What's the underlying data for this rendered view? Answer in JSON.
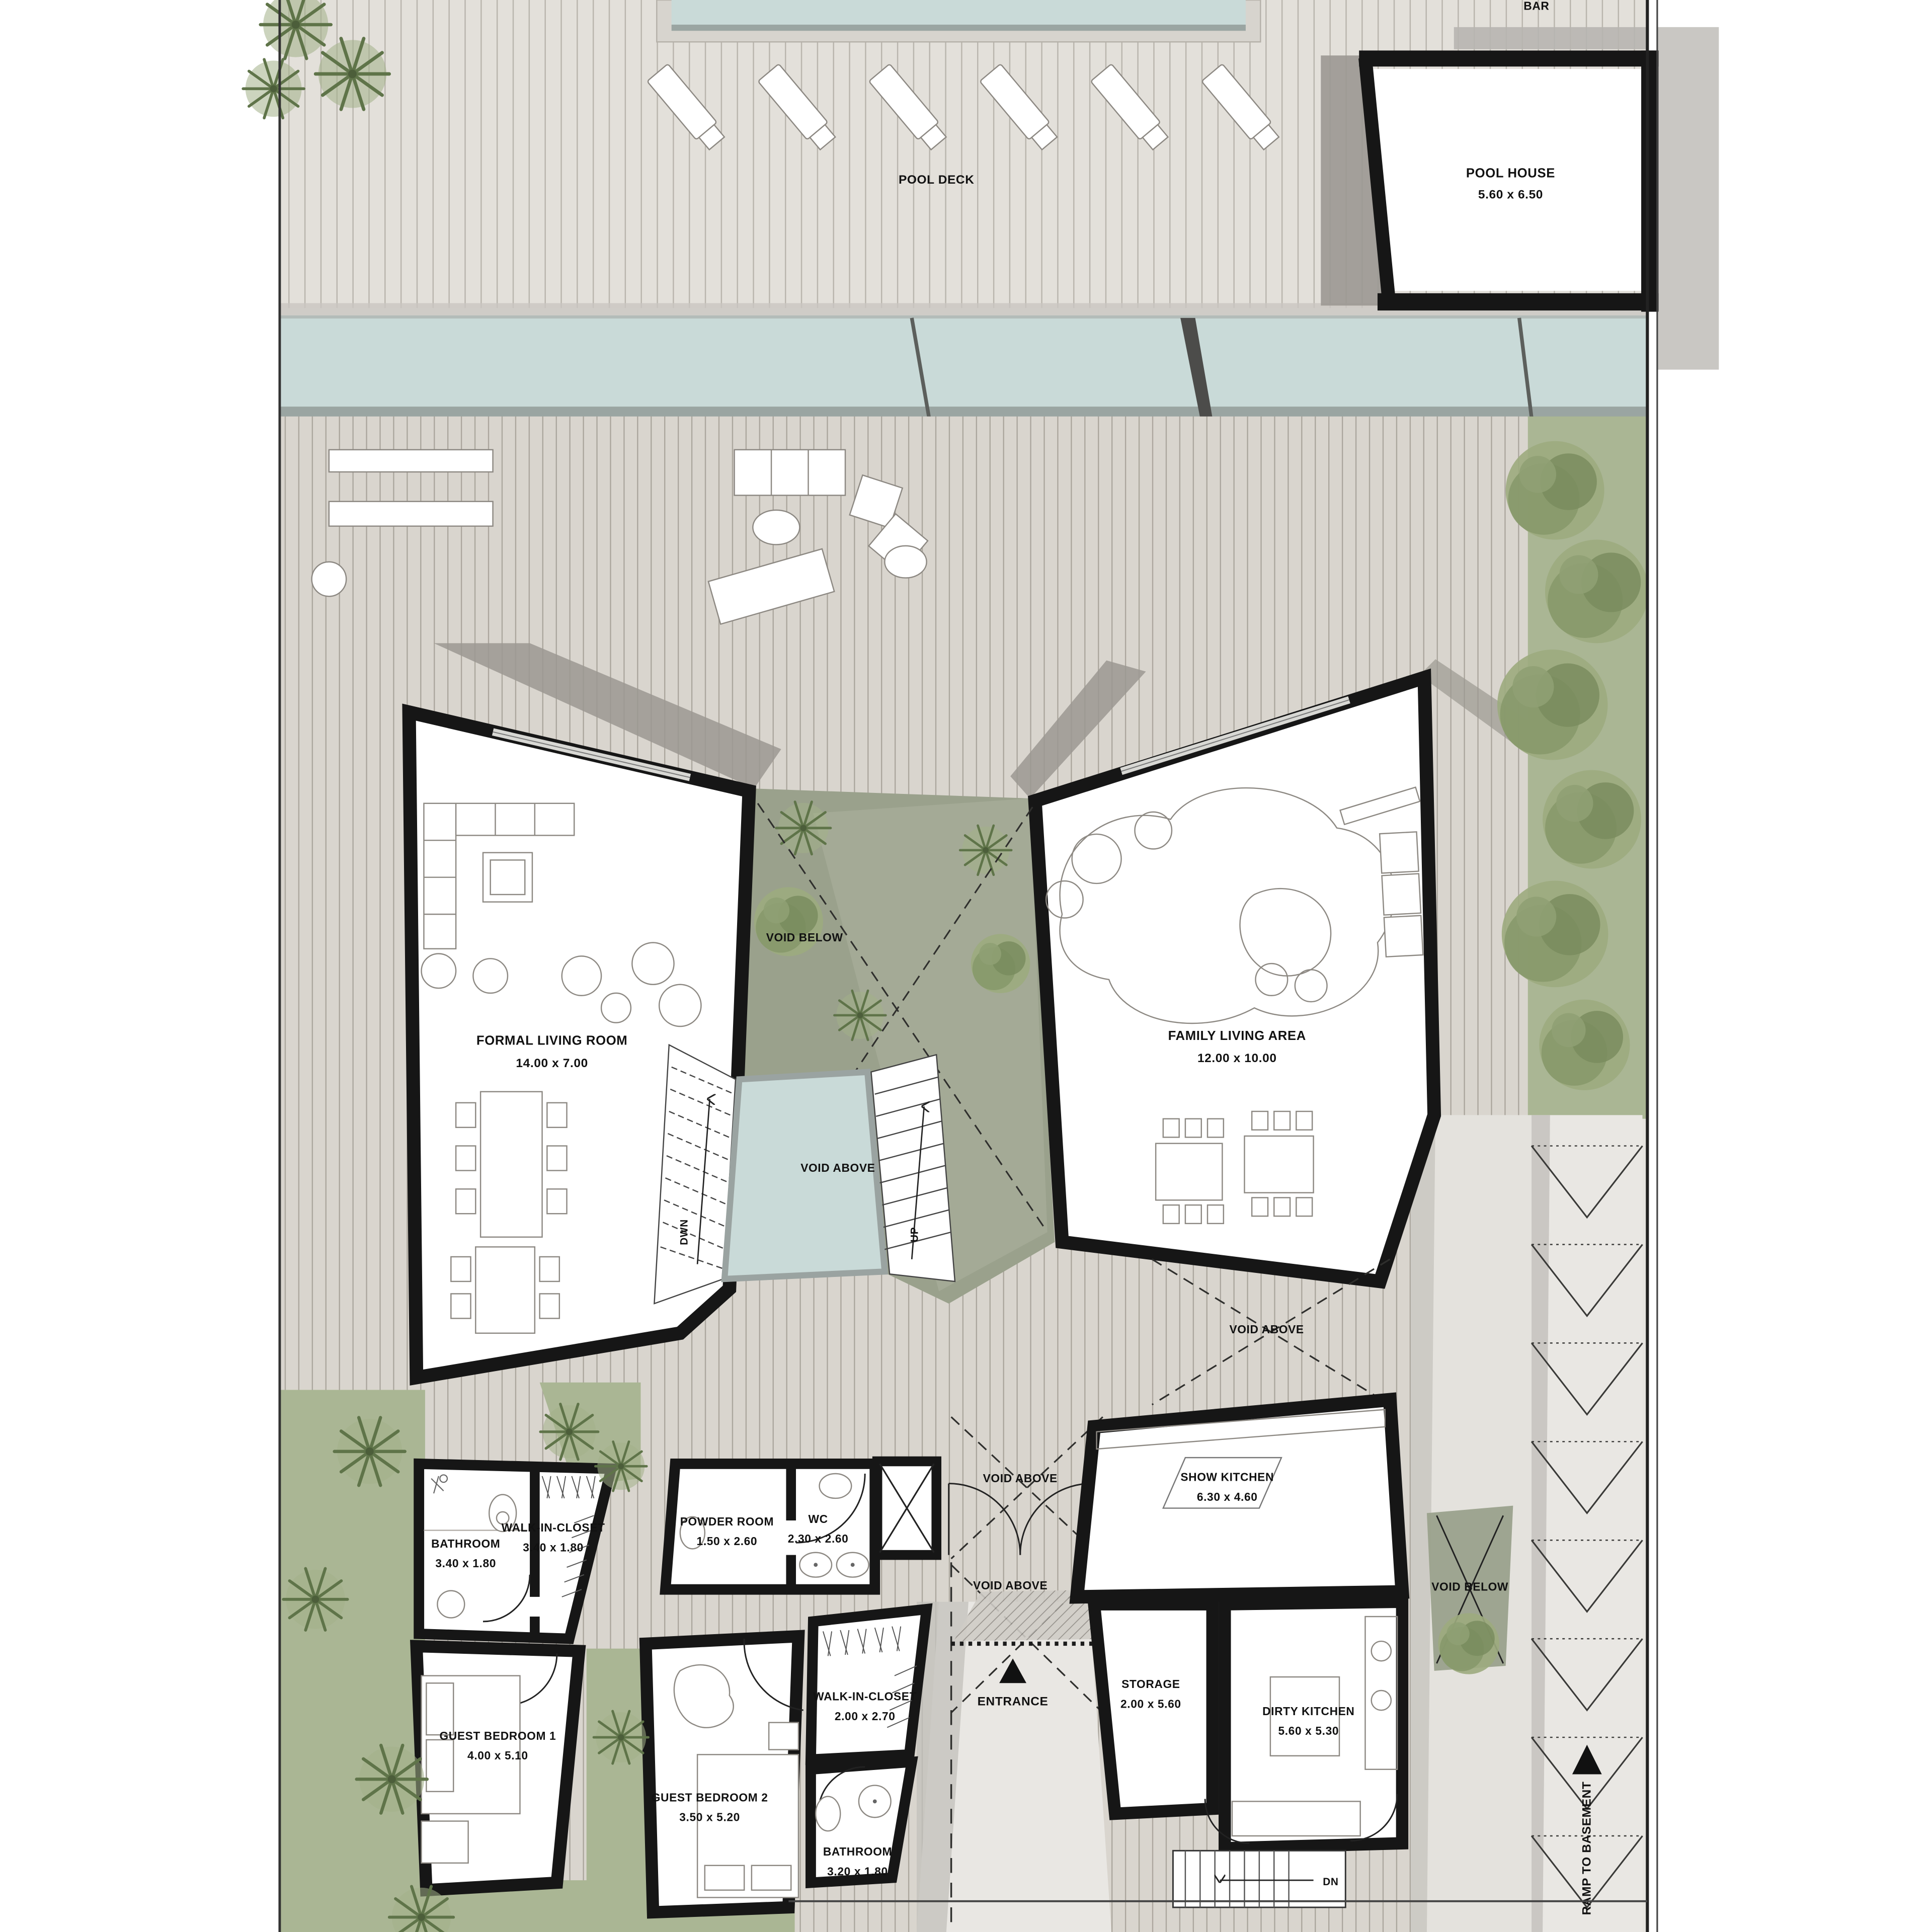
{
  "plan": {
    "areas": {
      "pool_deck": "POOL DECK",
      "bar": "BAR",
      "entrance": "ENTRANCE",
      "ramp_to_basement": "RAMP TO BASEMENT"
    },
    "rooms": {
      "pool_house": {
        "name": "POOL HOUSE",
        "dims": "5.60 x 6.50"
      },
      "formal_living_room": {
        "name": "FORMAL LIVING ROOM",
        "dims": "14.00 x 7.00"
      },
      "family_living_area": {
        "name": "FAMILY LIVING AREA",
        "dims": "12.00 x 10.00"
      },
      "bathroom_1": {
        "name": "BATHROOM",
        "dims": "3.40 x 1.80"
      },
      "walk_in_closet_1": {
        "name": "WALK-IN-CLOSET",
        "dims": "3.40 x 1.80"
      },
      "guest_bedroom_1": {
        "name": "GUEST BEDROOM 1",
        "dims": "4.00 x 5.10"
      },
      "powder_room": {
        "name": "POWDER ROOM",
        "dims": "1.50 x 2.60"
      },
      "wc": {
        "name": "WC",
        "dims": "2.30 x 2.60"
      },
      "guest_bedroom_2": {
        "name": "GUEST BEDROOM 2",
        "dims": "3.50 x 5.20"
      },
      "walk_in_closet_2": {
        "name": "WALK-IN-CLOSET",
        "dims": "2.00 x 2.70"
      },
      "bathroom_2": {
        "name": "BATHROOM",
        "dims": "3.20 x 1.80"
      },
      "show_kitchen": {
        "name": "SHOW KITCHEN",
        "dims": "6.30 x 4.60"
      },
      "storage": {
        "name": "STORAGE",
        "dims": "2.00 x 5.60"
      },
      "dirty_kitchen": {
        "name": "DIRTY KITCHEN",
        "dims": "5.60 x 5.30"
      }
    },
    "annotations": {
      "void_below": "VOID BELOW",
      "void_above": "VOID ABOVE",
      "stair_down": "DWN",
      "stair_up": "UP",
      "stair_dn": "DN"
    },
    "colors": {
      "wall": "#161616",
      "deck": "#d9d5ce",
      "deck_line": "#a8a39a",
      "pooldeck": "#e3e0da",
      "water": "#c9dad8",
      "water_edge": "#9aa5a2",
      "green": "#aab694",
      "green_dark": "#7e9162",
      "courtyard": "#9aa18c",
      "shadow": "#9b9892",
      "path": "#e6e4df"
    }
  }
}
